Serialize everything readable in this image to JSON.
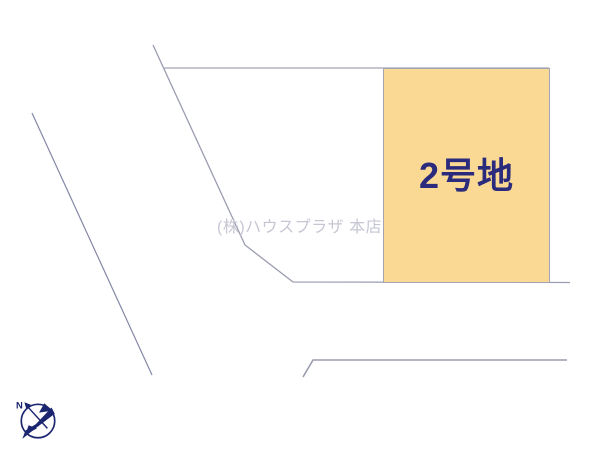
{
  "diagram": {
    "kind": "real-estate-lot-layout",
    "background_color": "#ffffff"
  },
  "lot2": {
    "label": "2号地",
    "fill_color": "#f9d993",
    "border_color": "#a3a4b4",
    "label_color": "#2b2b7d"
  },
  "watermark": {
    "text": "(株)ハウスプラザ 本店",
    "color": "#c7c7d4"
  },
  "compass": {
    "icon": "bird-north-arrow-compass",
    "label": "N",
    "color": "#1b2671"
  },
  "lines": {
    "parcel_line_color": "#9a9cb0",
    "road_line_color": "#8487a6"
  }
}
